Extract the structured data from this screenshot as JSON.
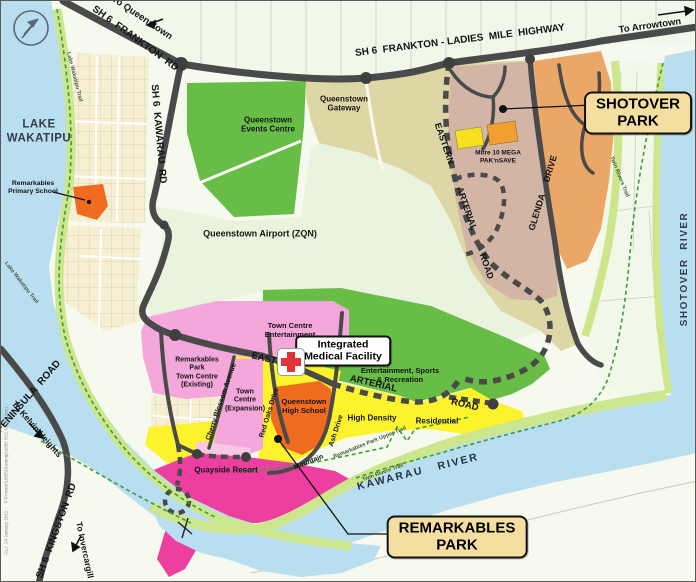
{
  "labels": {
    "lake": "LAKE\nWAKATIPU",
    "shotover_river": "SHOTOVER  RIVER",
    "kawarau_river": "KAWARAU   RIVER",
    "to_queenstown": "To Queenstown",
    "frankton_rd": "SH 6  FRANKTON  RD",
    "ladies_mile": "SH 6  FRANKTON - LADIES  MILE  HIGHWAY",
    "to_arrowtown": "To Arrowtown",
    "kawarau_rd": "SH 6  KAWARAU  RD",
    "events_centre": "Queenstown\nEvents Centre",
    "gateway": "Queenstown\nGateway",
    "airport": "Queenstown Airport (ZQN)",
    "mitre": "Mitre 10 MEGA\nPAK'nSAVE",
    "eastern_arterial_ne": "EASTERN  ARTERIAL  ROAD",
    "eastern_arterial_s": "EASTERN   ARTERIAL   ROAD",
    "glenda": "GLENDA  DRIVE",
    "town_centre_ent": "Town Centre\nEntertainment",
    "ent_sports": "Entertainment, Sports\n& Recreation",
    "rptc_existing": "Remarkables\nPark\nTown Centre\n(Existing)",
    "tc_expansion": "Town\nCentre\n(Expansion)",
    "cherry_blossom": "Cherry Blossom Avenue",
    "red_oaks": "Red Oaks Drive",
    "ash_drive": "Ash Drive",
    "mountain": "Mountain",
    "high_density": "High Density",
    "residential": "Residential",
    "quayside": "Quayside Resort",
    "high_school": "Queenstown\nHigh School",
    "peninsula_rd": "PENINSULA  ROAD",
    "to_kelvin": "To Kelvin Heights",
    "kingston_rd": "SH 6  KINGSTON  RD",
    "to_invercargill": "To Invercargill",
    "primary_school": "Remarkables\nPrimary School",
    "lake_trail": "Lake Wakatipu Trail",
    "twin_rivers": "Twin Rivers Trail",
    "upper_trail": "Remarkables Park Upper Trail",
    "callout_shotover": "SHOTOVER\nPARK",
    "callout_remarkables": "REMARKABLES\nPARK",
    "callout_medical": "Integrated\nMedical Facility",
    "fine_print": "GLJ  24 January 2011      P:\\Private\\1885\\Drawings\\1885 R21 12Dec.Dwg"
  },
  "colors": {
    "water": "#b9def0",
    "land": "#f6f9ee",
    "rural": "#f1f7e9",
    "riparian": "#cce68d",
    "shore_strip": "#cfe795",
    "green": "#67bd45",
    "airport_pale": "#e9f3dd",
    "tan": "#dcd7a4",
    "brown": "#d3b5a6",
    "orange_zone": "#eba768",
    "school_orange": "#ee6b1f",
    "pink": "#f4a7da",
    "pink_light": "#f8c7e6",
    "magenta": "#ec3f9f",
    "yellow": "#fdf32c",
    "cream": "#f6efd2",
    "road": "#4a4a4a",
    "trail_green": "#3c9b3c",
    "callout_bg": "#f5dfa0",
    "white": "#ffffff",
    "mitre_yellow": "#f7e11e",
    "paknsave_orange": "#f0a030",
    "cross_red": "#e23434",
    "dark_text": "#141414",
    "water_text": "#333c49"
  }
}
